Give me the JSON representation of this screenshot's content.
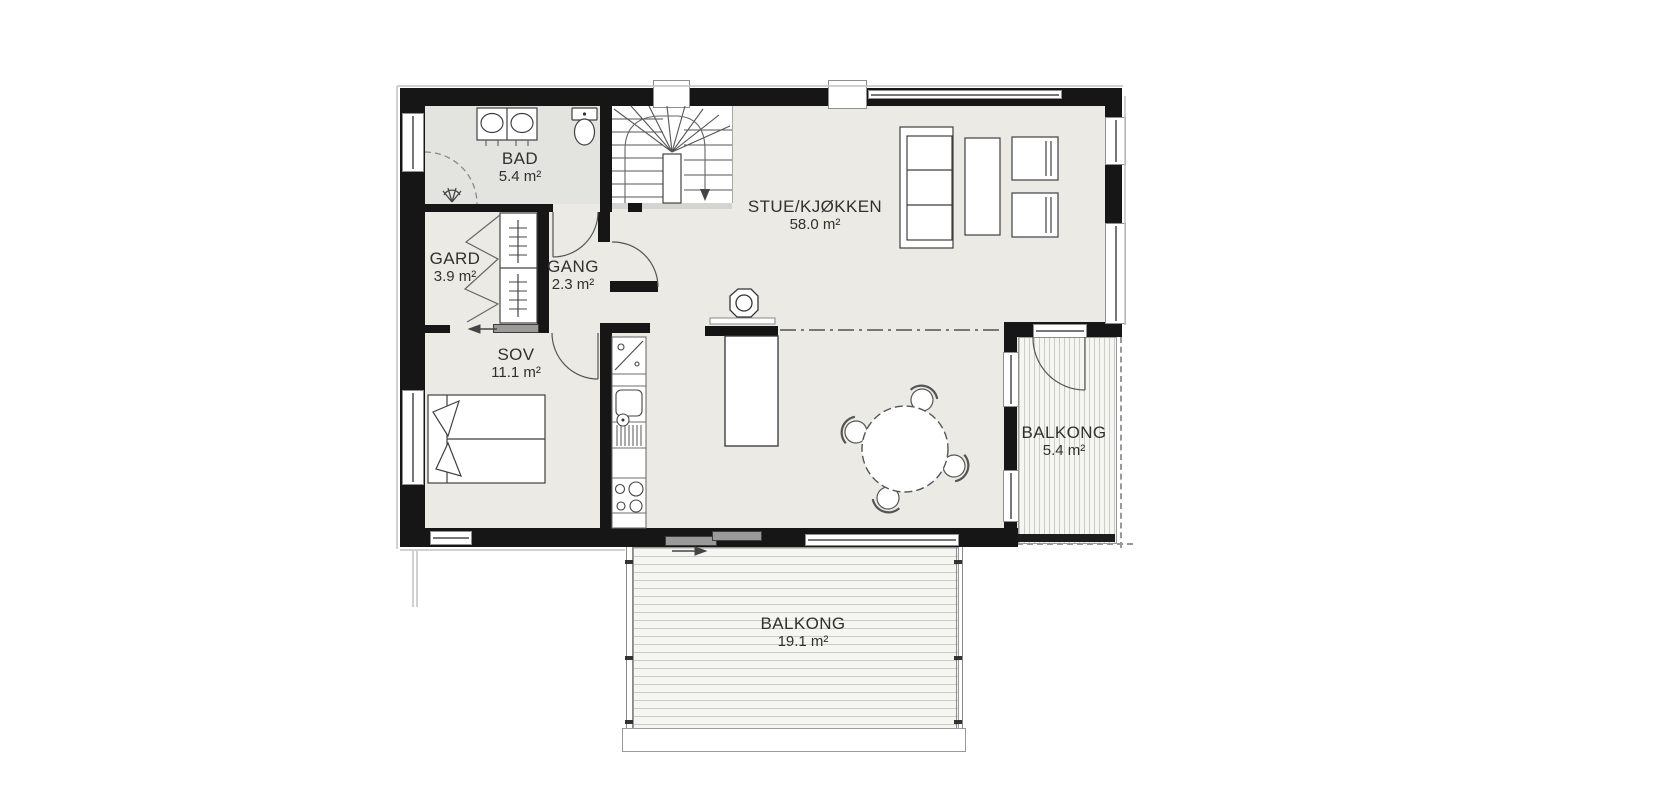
{
  "plan": {
    "rooms": [
      {
        "id": "bad",
        "label": "BAD",
        "area": "5.4 m²"
      },
      {
        "id": "gard",
        "label": "GARD",
        "area": "3.9 m²"
      },
      {
        "id": "gang",
        "label": "GANG",
        "area": "2.3 m²"
      },
      {
        "id": "stue_kjokken",
        "label": "STUE/KJØKKEN",
        "area": "58.0 m²"
      },
      {
        "id": "sov",
        "label": "SOV",
        "area": "11.1 m²"
      },
      {
        "id": "balkong_right",
        "label": "BALKONG",
        "area": "5.4 m²"
      },
      {
        "id": "balkong_bottom",
        "label": "BALKONG",
        "area": "19.1 m²"
      }
    ],
    "fixtures": [
      "winder-stair",
      "double-sink-vanity",
      "toilet",
      "corner-shower",
      "wardrobe",
      "double-bed",
      "kitchen-counter",
      "dishwasher-symbol",
      "kitchen-sink",
      "stove-4-burner",
      "kitchen-island",
      "wood-stove",
      "sofa-3-seat",
      "coffee-table",
      "armchair",
      "armchair",
      "round-dining-table",
      "dining-chairs-4",
      "sliding-door",
      "hinged-door",
      "balcony-decking"
    ],
    "colors": {
      "wall": "#161616",
      "floor": "#ebeae4",
      "floor_bathroom": "#e3e3e0",
      "deck_line": "#cbcbc5",
      "label": "#303030"
    }
  }
}
